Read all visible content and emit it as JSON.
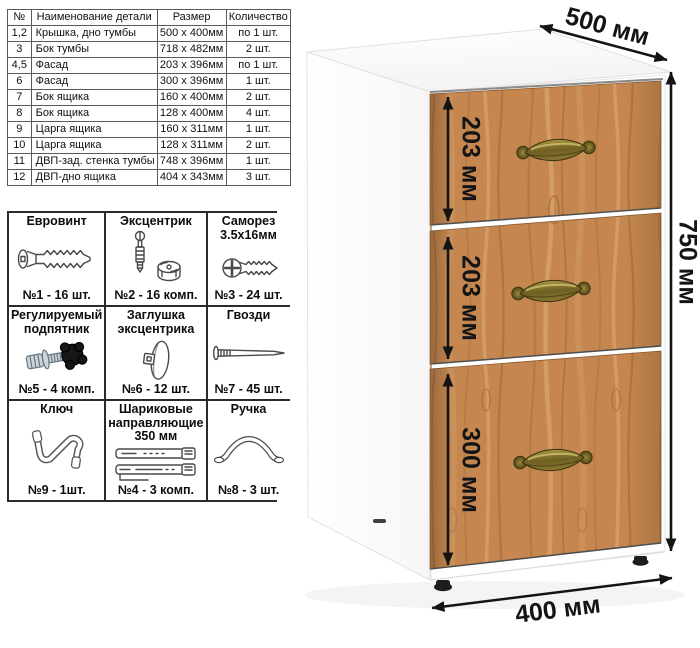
{
  "parts_table": {
    "headers": [
      "№",
      "Наименование детали",
      "Размер",
      "Количество"
    ],
    "rows": [
      [
        "1,2",
        "Крышка, дно тумбы",
        "500 х 400мм",
        "по 1 шт."
      ],
      [
        "3",
        "Бок тумбы",
        "718 х 482мм",
        "2 шт."
      ],
      [
        "4,5",
        "Фасад",
        "203 х 396мм",
        "по 1 шт."
      ],
      [
        "6",
        "Фасад",
        "300 х 396мм",
        "1 шт."
      ],
      [
        "7",
        "Бок ящика",
        "160 х 400мм",
        "2 шт."
      ],
      [
        "8",
        "Бок ящика",
        "128 х 400мм",
        "4 шт."
      ],
      [
        "9",
        "Царга ящика",
        "160 х 311мм",
        "1 шт."
      ],
      [
        "10",
        "Царга ящика",
        "128 х 311мм",
        "2 шт."
      ],
      [
        "11",
        "ДВП-зад. стенка тумбы",
        "748 х 396мм",
        "1 шт."
      ],
      [
        "12",
        "ДВП-дно ящика",
        "404 х 343мм",
        "3 шт."
      ]
    ]
  },
  "hardware": {
    "items": [
      {
        "title": "Евровинт",
        "count": "№1 - 16 шт.",
        "icon": "euro-screw"
      },
      {
        "title": "Эксцентрик",
        "count": "№2 - 16 комп.",
        "icon": "cam-lock"
      },
      {
        "title": "Саморез 3.5х16мм",
        "count": "№3 - 24 шт.",
        "icon": "self-tapping-screw"
      },
      {
        "title": "Регулируемый подпятник",
        "count": "№5 - 4 комп.",
        "icon": "adjustable-foot"
      },
      {
        "title": "Заглушка эксцентрика",
        "count": "№6 - 12 шт.",
        "icon": "cam-cover"
      },
      {
        "title": "Гвозди",
        "count": "№7 - 45 шт.",
        "icon": "nail"
      },
      {
        "title": "Ключ",
        "count": "№9 - 1шт.",
        "icon": "hex-key"
      },
      {
        "title": "Шариковые направляющие 350 мм",
        "count": "№4 - 3 комп.",
        "icon": "ball-bearing-slides"
      },
      {
        "title": "Ручка",
        "count": "№8 - 3 шт.",
        "icon": "handle"
      }
    ]
  },
  "cabinet": {
    "width_label": "500 мм",
    "height_label": "750 мм",
    "depth_label": "400 мм",
    "drawer_labels": [
      "203 мм",
      "203 мм",
      "300 мм"
    ],
    "colors": {
      "wood": "#c5874f",
      "handle_brass": "#857231",
      "body": "#ffffff",
      "dimension": "#141414"
    }
  }
}
